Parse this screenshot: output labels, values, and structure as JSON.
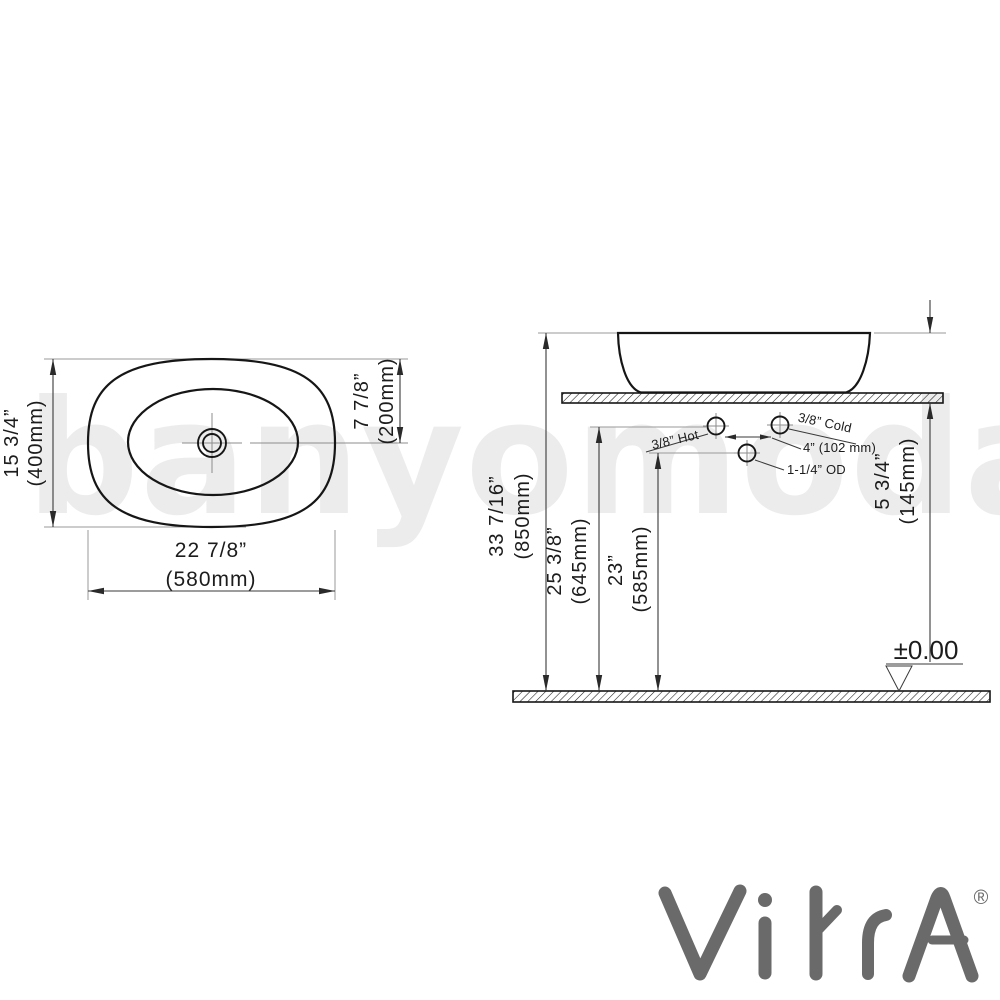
{
  "watermark_text": "banyomoda",
  "brand": {
    "name": "VitrA",
    "registered_mark": "®"
  },
  "plan_view": {
    "width_in": "22 7/8”",
    "width_mm": "(580mm)",
    "depth_in": "15 3/4”",
    "depth_mm": "(400mm)",
    "drain_center_in": "7 7/8”",
    "drain_center_mm": "(200mm)"
  },
  "side_view": {
    "rim_height_in": "33 7/16”",
    "rim_height_mm": "(850mm)",
    "supply_height_in": "25 3/8”",
    "supply_height_mm": "(645mm)",
    "waste_height_in": "23”",
    "waste_height_mm": "(585mm)",
    "basin_height_in": "5 3/4”",
    "basin_height_mm": "(145mm)",
    "hot_supply": "3/8” Hot",
    "cold_supply": "3/8” Cold",
    "supply_spacing": "4” (102 mm)",
    "waste_outlet": "1-1/4” OD",
    "datum": "±0.00"
  }
}
